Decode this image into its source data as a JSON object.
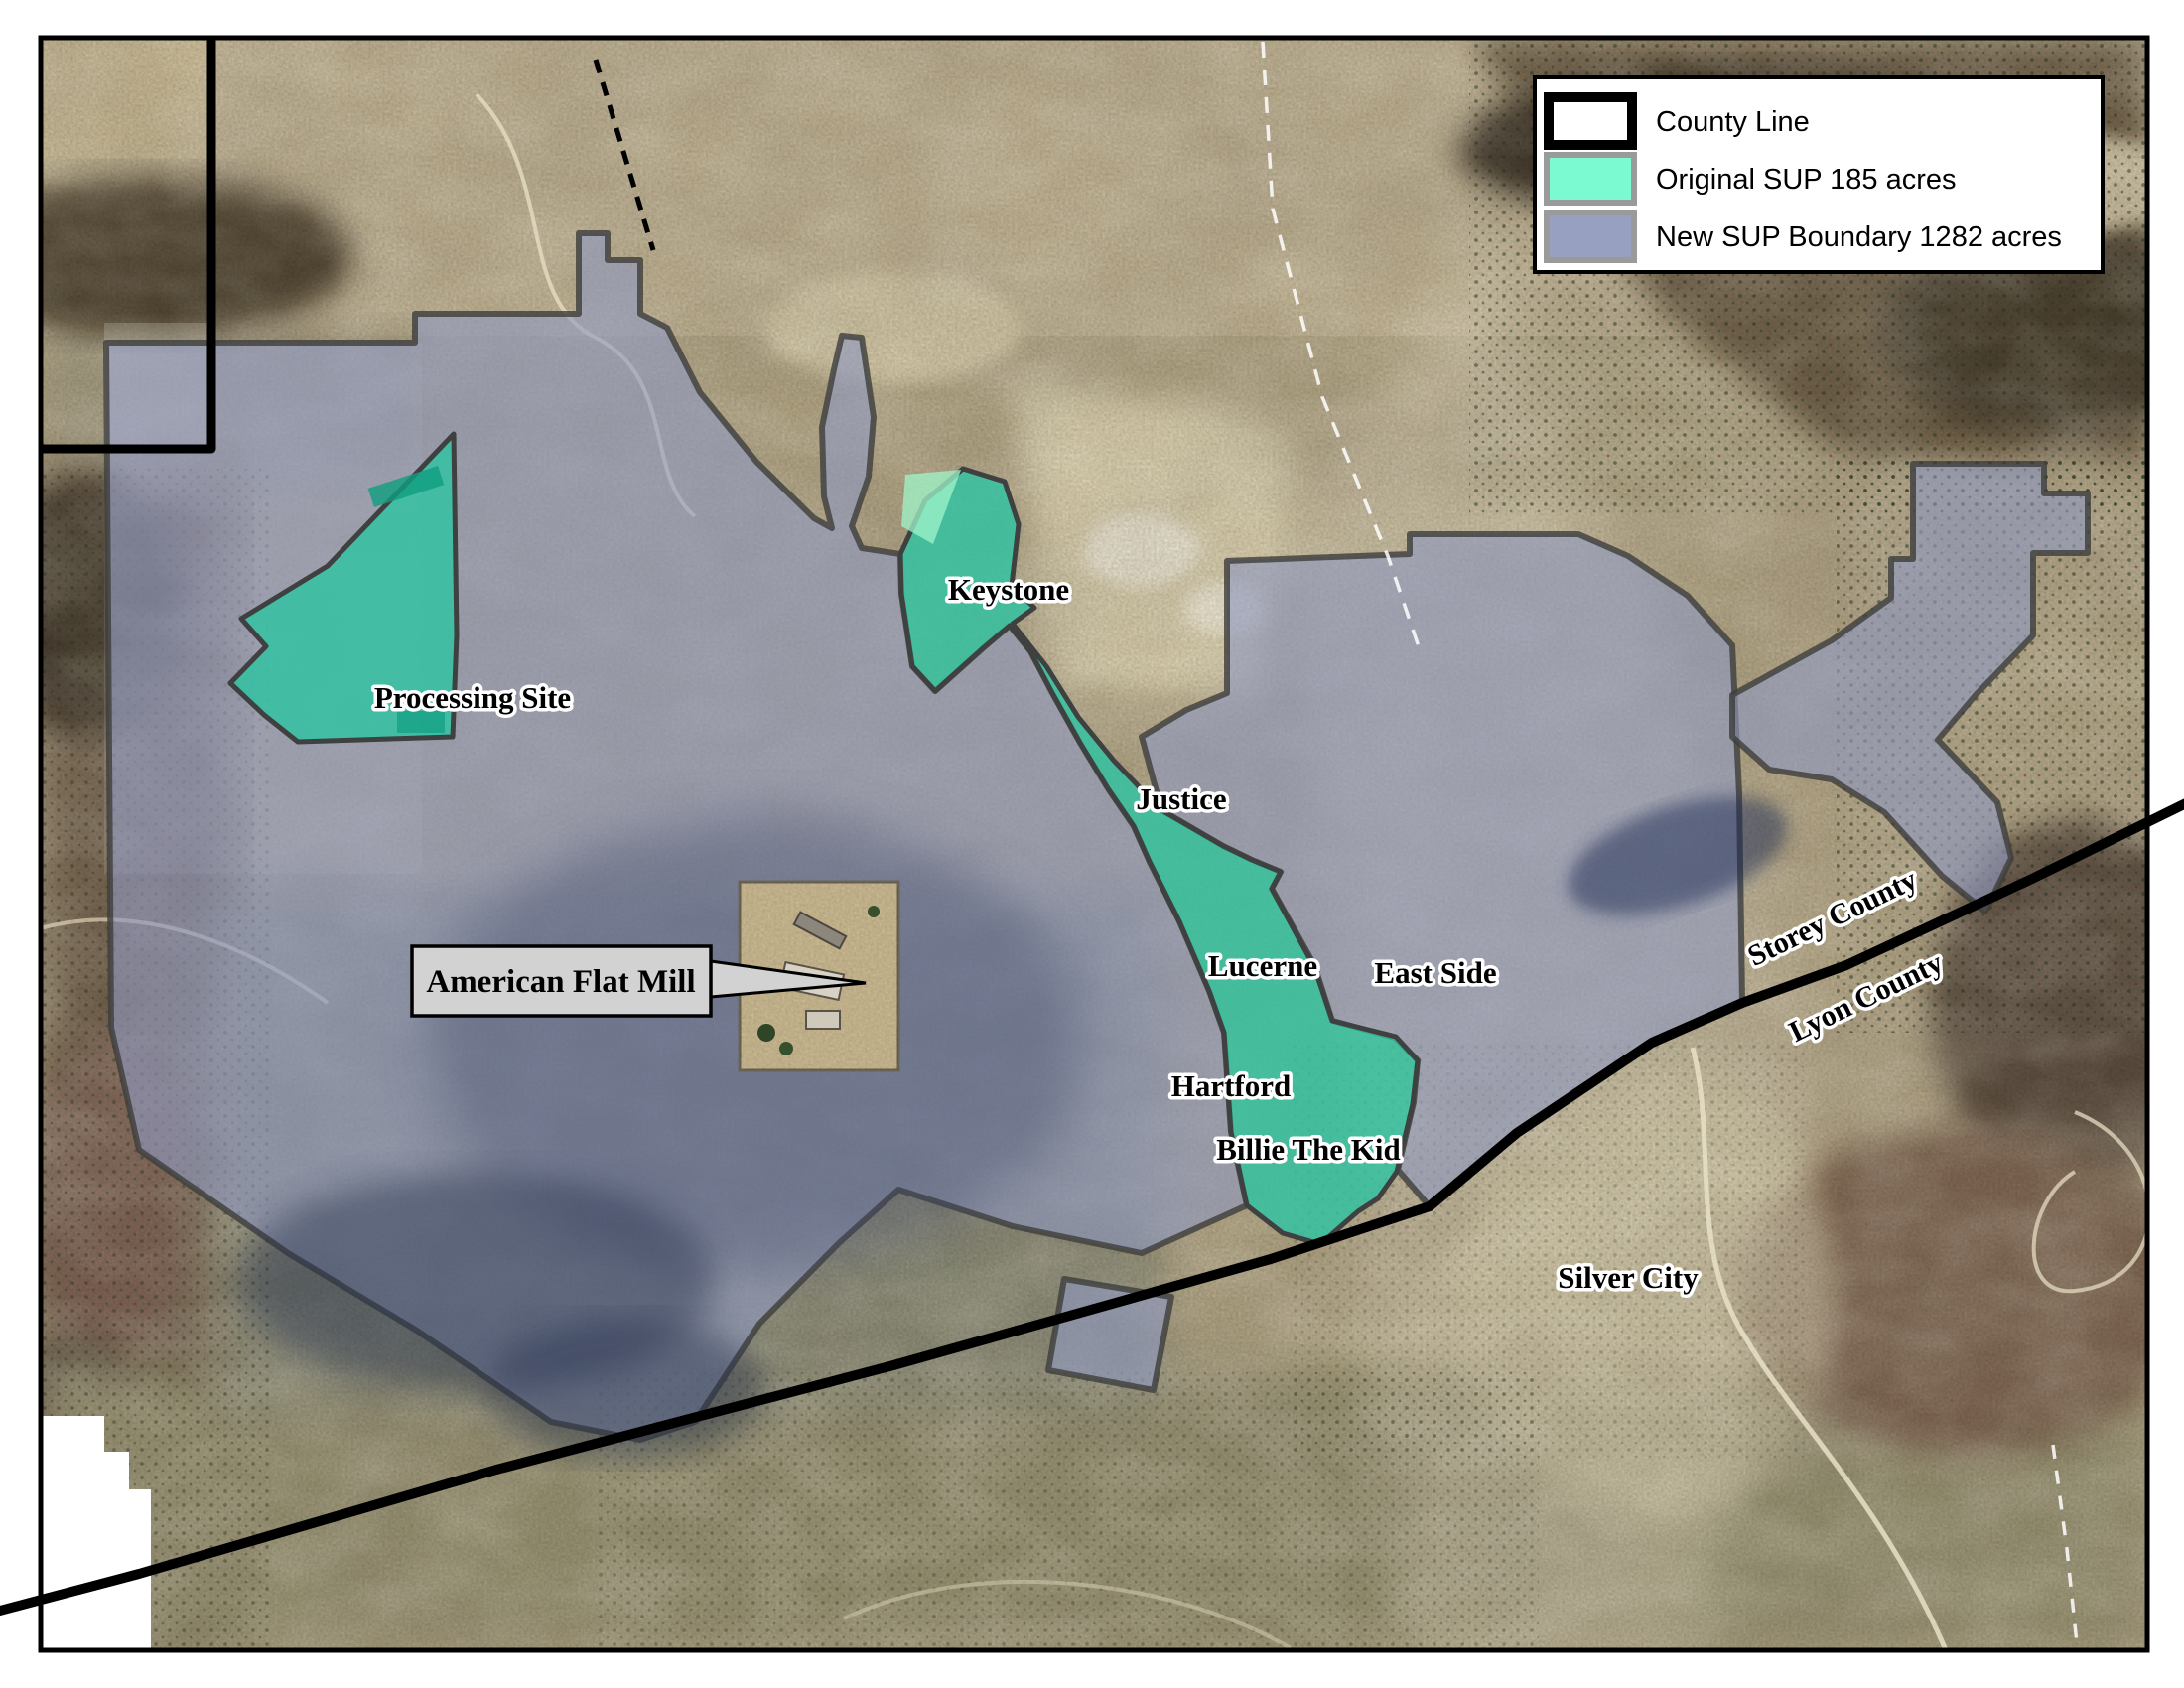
{
  "legend": {
    "items": [
      {
        "id": "county-line",
        "label": "County Line",
        "fill": "#FFFFFF",
        "border": "#000000"
      },
      {
        "id": "original-sup",
        "label": "Original SUP 185 acres",
        "fill": "#7BFAD2",
        "border": "#9A9A9A"
      },
      {
        "id": "new-sup",
        "label": "New SUP Boundary 1282 acres",
        "fill": "#97A0C0",
        "border": "#9A9A9A"
      }
    ]
  },
  "labels": {
    "processing_site": "Processing Site",
    "keystone": "Keystone",
    "justice": "Justice",
    "lucerne": "Lucerne",
    "east_side": "East Side",
    "hartford": "Hartford",
    "billie_the_kid": "Billie The Kid",
    "silver_city": "Silver City",
    "storey_county": "Storey County",
    "lyon_county": "Lyon County"
  },
  "callout": {
    "label": "American Flat Mill"
  },
  "colors": {
    "original_sup_map": "#30C3A2",
    "new_sup_map": "#8F9AC0",
    "county_line": "#000000",
    "boundary_stroke": "#3D3D3B"
  }
}
